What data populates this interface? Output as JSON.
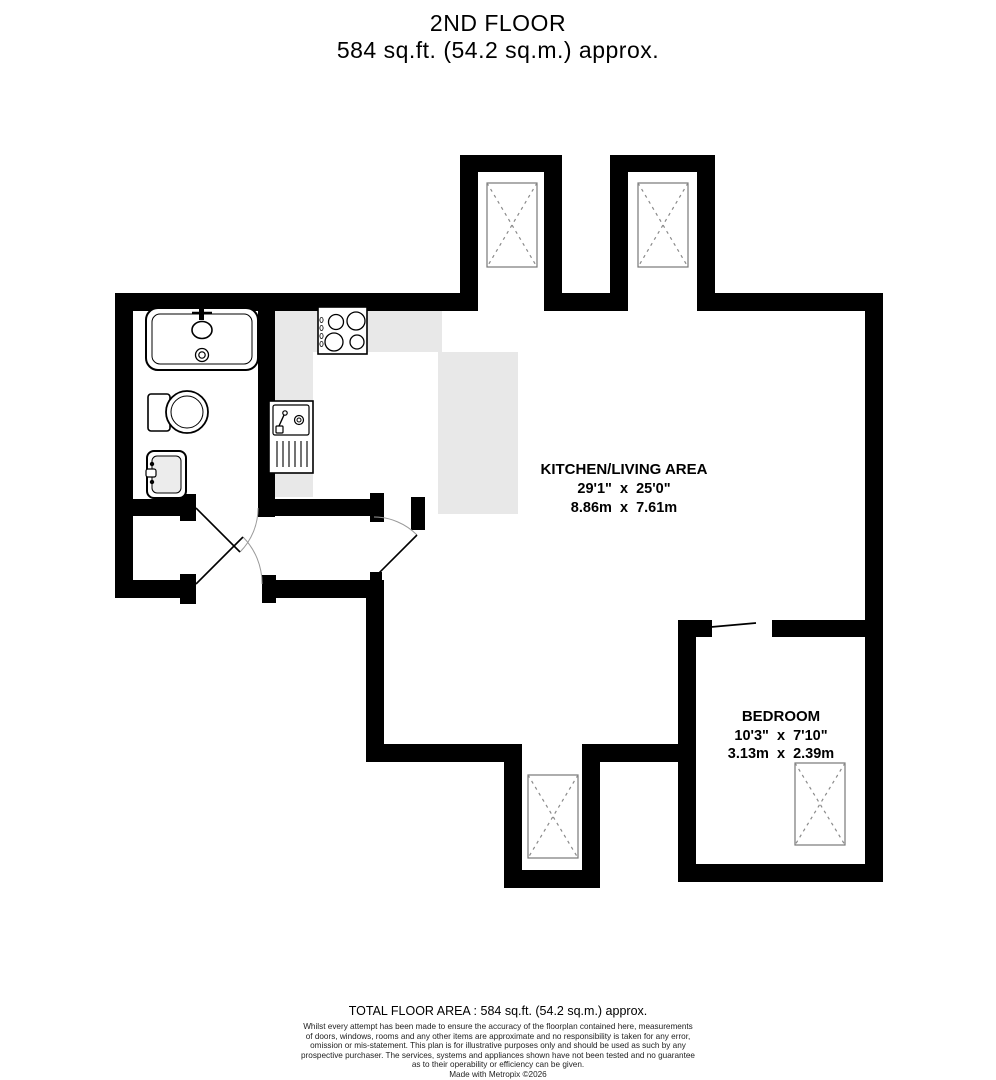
{
  "header": {
    "floor_label": "2ND FLOOR",
    "area_label": "584 sq.ft. (54.2 sq.m.) approx."
  },
  "rooms": [
    {
      "name": "KITCHEN/LIVING AREA",
      "size_imperial": "29'1\"  x  25'0\"",
      "size_metric": "8.86m  x  7.61m"
    },
    {
      "name": "BEDROOM",
      "size_imperial": "10'3\"  x  7'10\"",
      "size_metric": "3.13m  x  2.39m"
    }
  ],
  "footer": {
    "total_area": "TOTAL FLOOR AREA : 584 sq.ft. (54.2 sq.m.) approx.",
    "disclaimer_lines": [
      "Whilst every attempt has been made to ensure the accuracy of the floorplan contained here, measurements",
      "of doors, windows, rooms and any other items are approximate and no responsibility is taken for any error,",
      "omission or mis-statement. This plan is for illustrative purposes only and should be used as such by any",
      "prospective purchaser. The services, systems and appliances shown have not been tested and no guarantee",
      "as to their operability or efficiency can be given."
    ],
    "credit": "Made with Metropix ©2026"
  },
  "colors": {
    "wall": "#000000",
    "counter": "#e8e8e8",
    "window_frame": "#777777",
    "window_cross": "#8a8a8a",
    "door_arc": "#9a9a9a",
    "basin_fill": "#ececec"
  }
}
